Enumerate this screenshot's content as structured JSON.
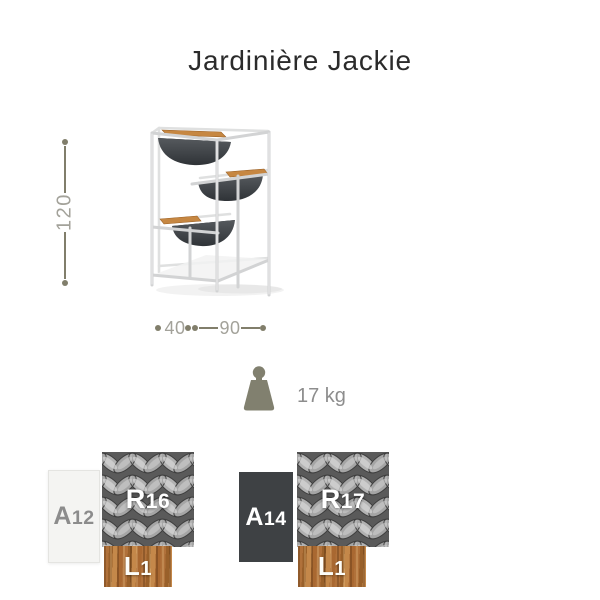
{
  "product": {
    "title": "Jardinière Jackie",
    "weight": "17 kg",
    "dimensions": {
      "height": "120",
      "depth": "40",
      "width": "90"
    }
  },
  "icons": {
    "weight": "weight-icon",
    "dimension_dots": "dimension-endpoint-dot"
  },
  "finishes": [
    {
      "frame": {
        "code": "A12",
        "letter": "A",
        "number": "12"
      },
      "rope": {
        "code": "R16",
        "letter": "R",
        "number": "16"
      },
      "wood": {
        "code": "L1",
        "letter": "L",
        "number": "1"
      }
    },
    {
      "frame": {
        "code": "A14",
        "letter": "A",
        "number": "14"
      },
      "rope": {
        "code": "R17",
        "letter": "R",
        "number": "17"
      },
      "wood": {
        "code": "L1",
        "letter": "L",
        "number": "1"
      }
    }
  ],
  "colors": {
    "title_text": "#2b2b2b",
    "dimension_lines": "#817e6b",
    "dimension_text": "#a3a29a",
    "weight_icon": "#81806f",
    "weight_text": "#8d8d8d",
    "swatch_frame_light": "#f4f4f2",
    "swatch_frame_dark": "#3e4144",
    "swatch_wood": "#aa6c31",
    "swatch_rope_base": "#8f8f8f",
    "product_frame": "#d2d3d4",
    "product_bowl": "#3c4044",
    "product_wood_trim": "#c68742"
  }
}
